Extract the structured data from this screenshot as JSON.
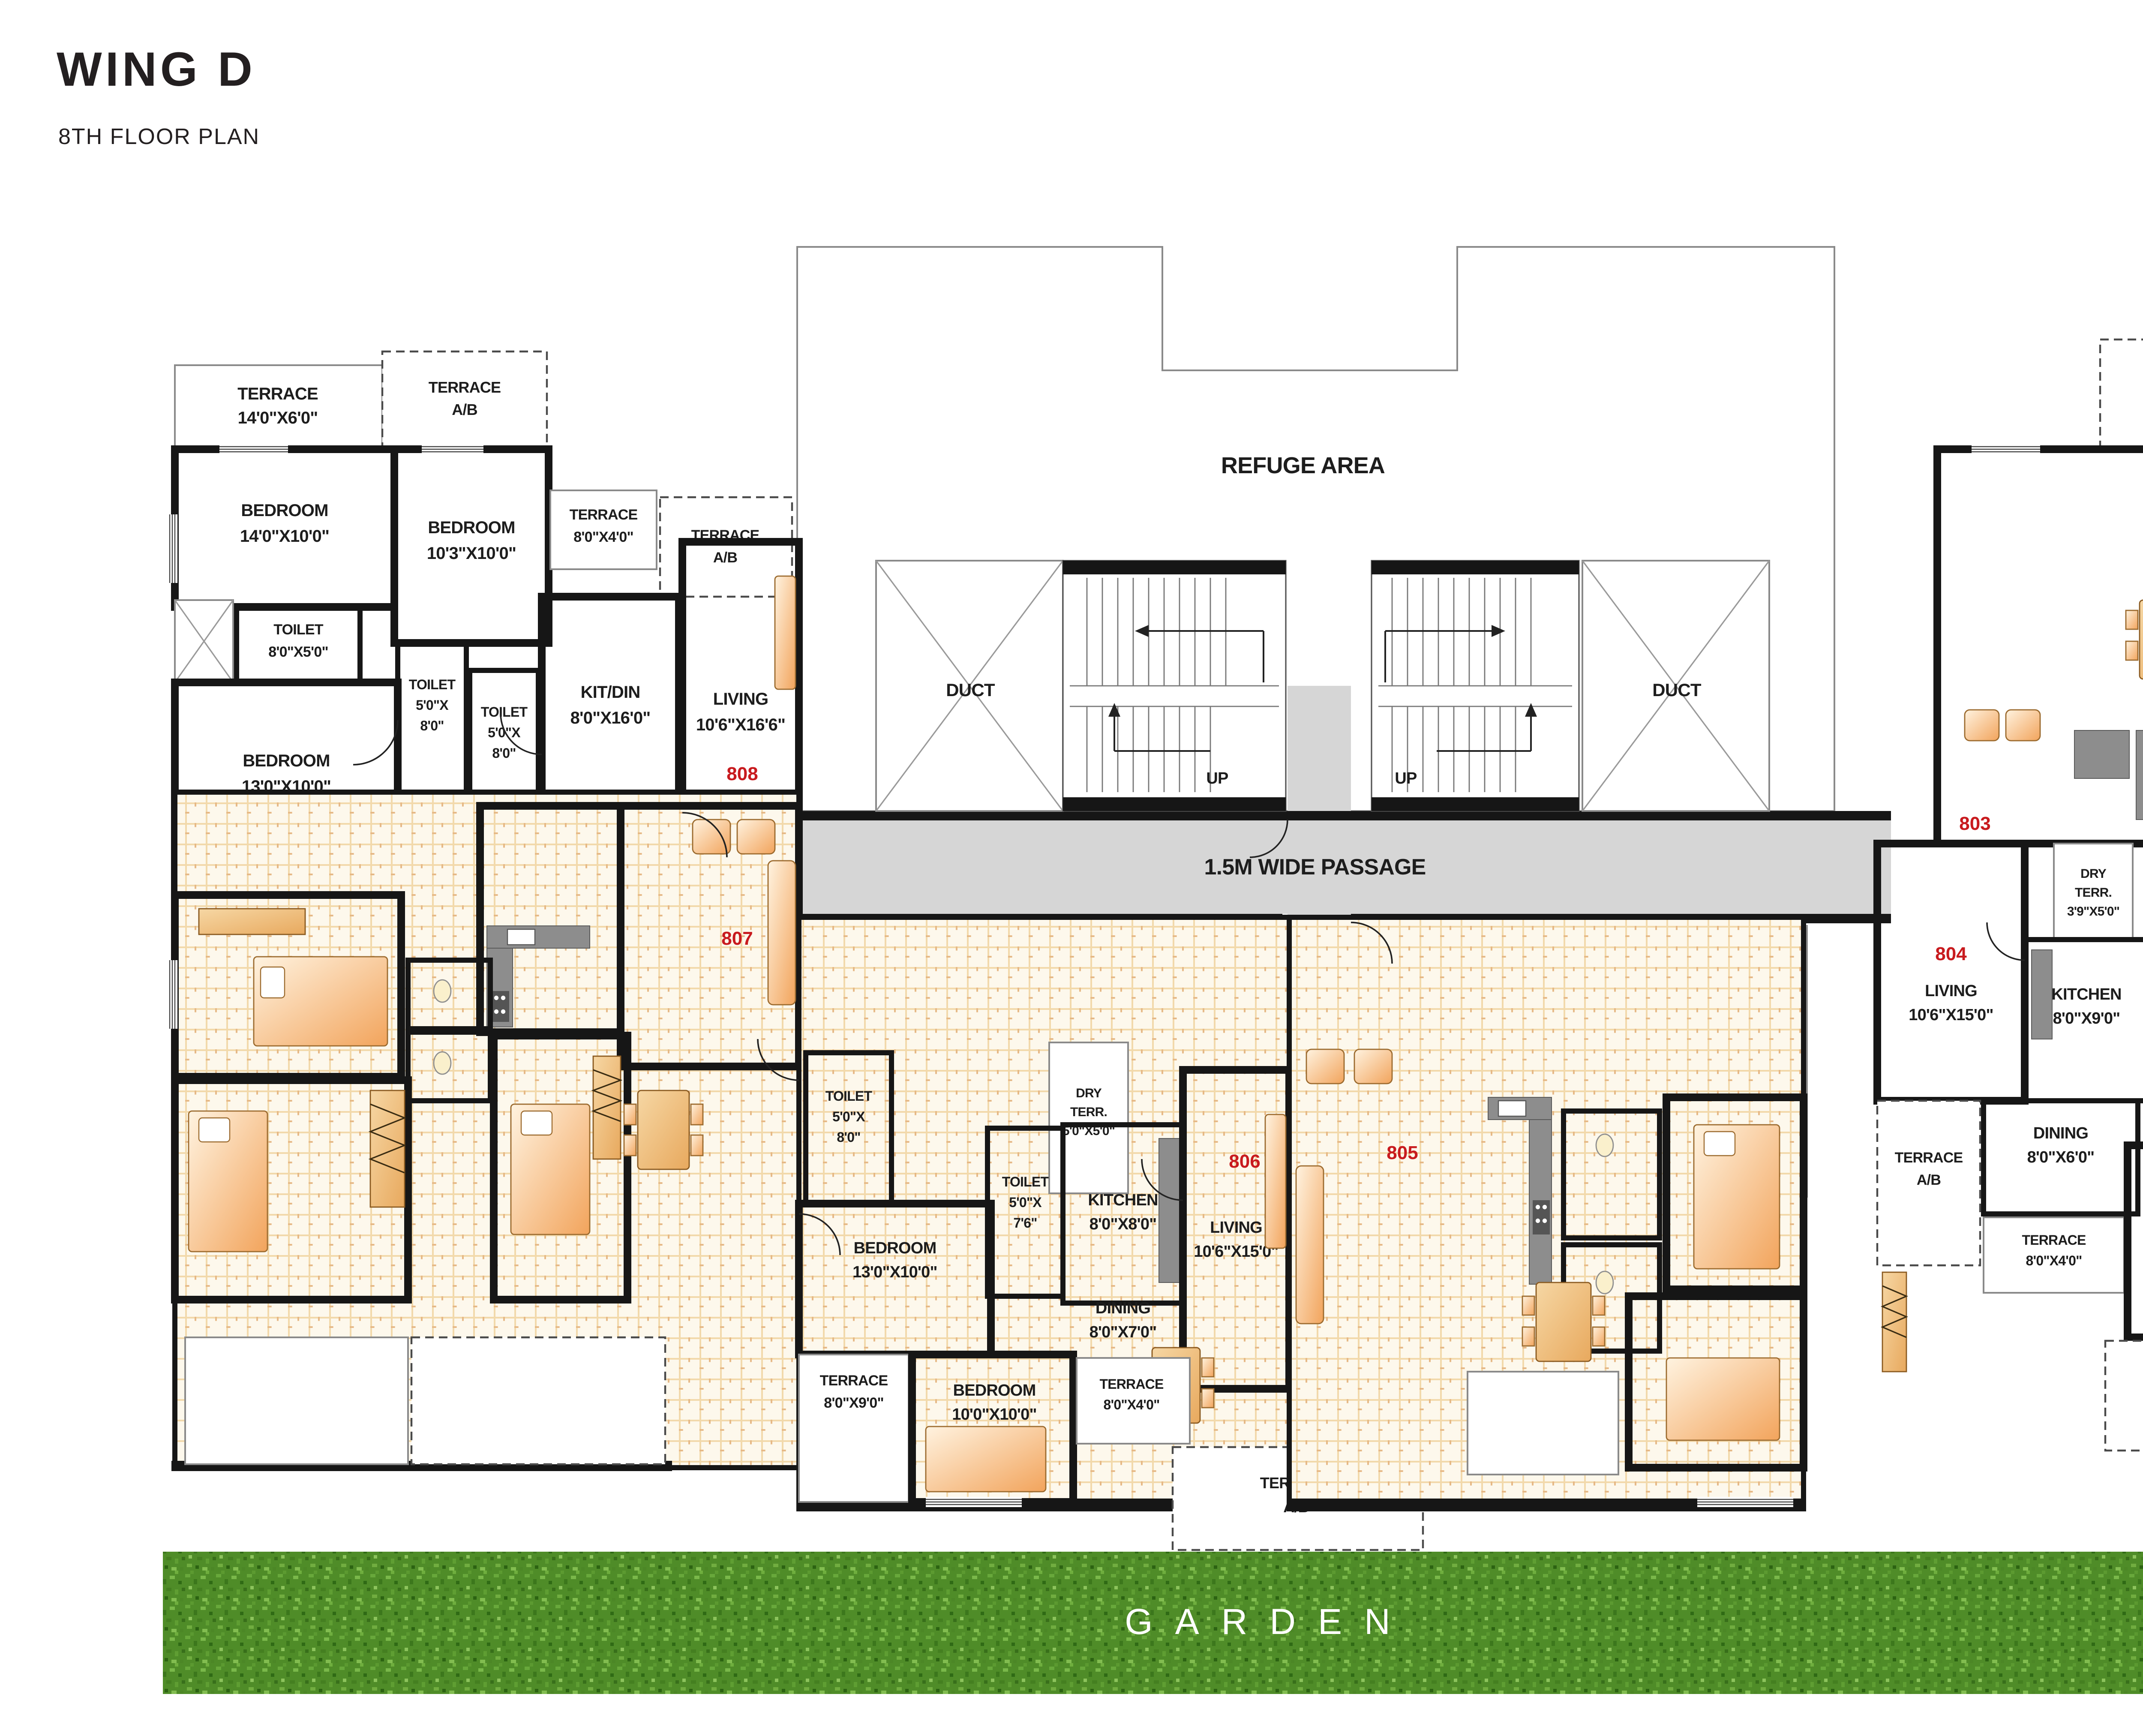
{
  "title": {
    "wing": "WING D",
    "floor": "8TH FLOOR PLAN"
  },
  "core": {
    "refuge_area": "REFUGE AREA",
    "passage": "1.5M WIDE PASSAGE",
    "duct": "DUCT",
    "lift": "LIFT",
    "up": "UP"
  },
  "units": {
    "u803": "803",
    "u804": "804",
    "u805": "805",
    "u806": "806",
    "u807": "807",
    "u808": "808"
  },
  "shared": {
    "terrace_ab": {
      "name": "TERRACE",
      "size": "A/B"
    }
  },
  "rooms": {
    "terrace_14x6": {
      "name": "TERRACE",
      "size": "14'0\"X6'0\""
    },
    "bedroom_14x10": {
      "name": "BEDROOM",
      "size": "14'0\"X10'0\""
    },
    "bedroom_10_3x10": {
      "name": "BEDROOM",
      "size": "10'3\"X10'0\""
    },
    "terrace_8x4": {
      "name": "TERRACE",
      "size": "8'0\"X4'0\""
    },
    "toilet_8x5": {
      "name": "TOILET",
      "size": "8'0\"X5'0\""
    },
    "toilet_5x8": {
      "lines": [
        "TOILET",
        "5'0\"X",
        "8'0\""
      ]
    },
    "bedroom_13x10": {
      "name": "BEDROOM",
      "size": "13'0\"X10'0\""
    },
    "kit_din_8x16": {
      "name": "KIT/DIN",
      "size": "8'0\"X16'0\""
    },
    "living_10_6x16_6": {
      "name": "LIVING",
      "size": "10'6\"X16'6\""
    },
    "dry_terr_3_9x5": {
      "lines": [
        "DRY",
        "TERR.",
        "3'9\"X5'0\""
      ]
    },
    "dry_terr_5x5": {
      "lines": [
        "DRY",
        "TERR.",
        "5'0\"X5'0\""
      ]
    },
    "toilet_5x7_6": {
      "lines": [
        "TOILET",
        "5'0\"X",
        "7'6\""
      ]
    },
    "kitchen_8x8": {
      "name": "KITCHEN",
      "size": "8'0\"X8'0\""
    },
    "living_10_6x15": {
      "name": "LIVING",
      "size": "10'6\"X15'0\""
    },
    "dining_8x7": {
      "name": "DINING",
      "size": "8'0\"X7'0\""
    },
    "terrace_8x9": {
      "name": "TERRACE",
      "size": "8'0\"X9'0\""
    },
    "bedroom_10x10": {
      "name": "BEDROOM",
      "size": "10'0\"X10'0\""
    },
    "kitchen_8x9": {
      "name": "KITCHEN",
      "size": "8'0\"X9'0\""
    },
    "toilet_5x9": {
      "lines": [
        "TOILET",
        "5'0\"X",
        "9'0\""
      ]
    },
    "dining_8x6": {
      "name": "DINING",
      "size": "8'0\"X6'0\""
    }
  },
  "garden": {
    "label": "GARDEN"
  },
  "compass": {
    "north": "N",
    "east": "E",
    "south": "S",
    "west": "W"
  },
  "colors": {
    "wall": "#161616",
    "unit_number": "#c81a1e",
    "passage_fill": "#d6d6d6",
    "terrace_hatch_dot": "#bf6b38",
    "toilet_dot": "#a8cfe8",
    "tile_line": "#f2d9ab",
    "garden_green": "#4f8c28",
    "compass_navy": "#2b2e7f",
    "compass_orange": "#d4882f",
    "compass_red": "#d42027"
  }
}
